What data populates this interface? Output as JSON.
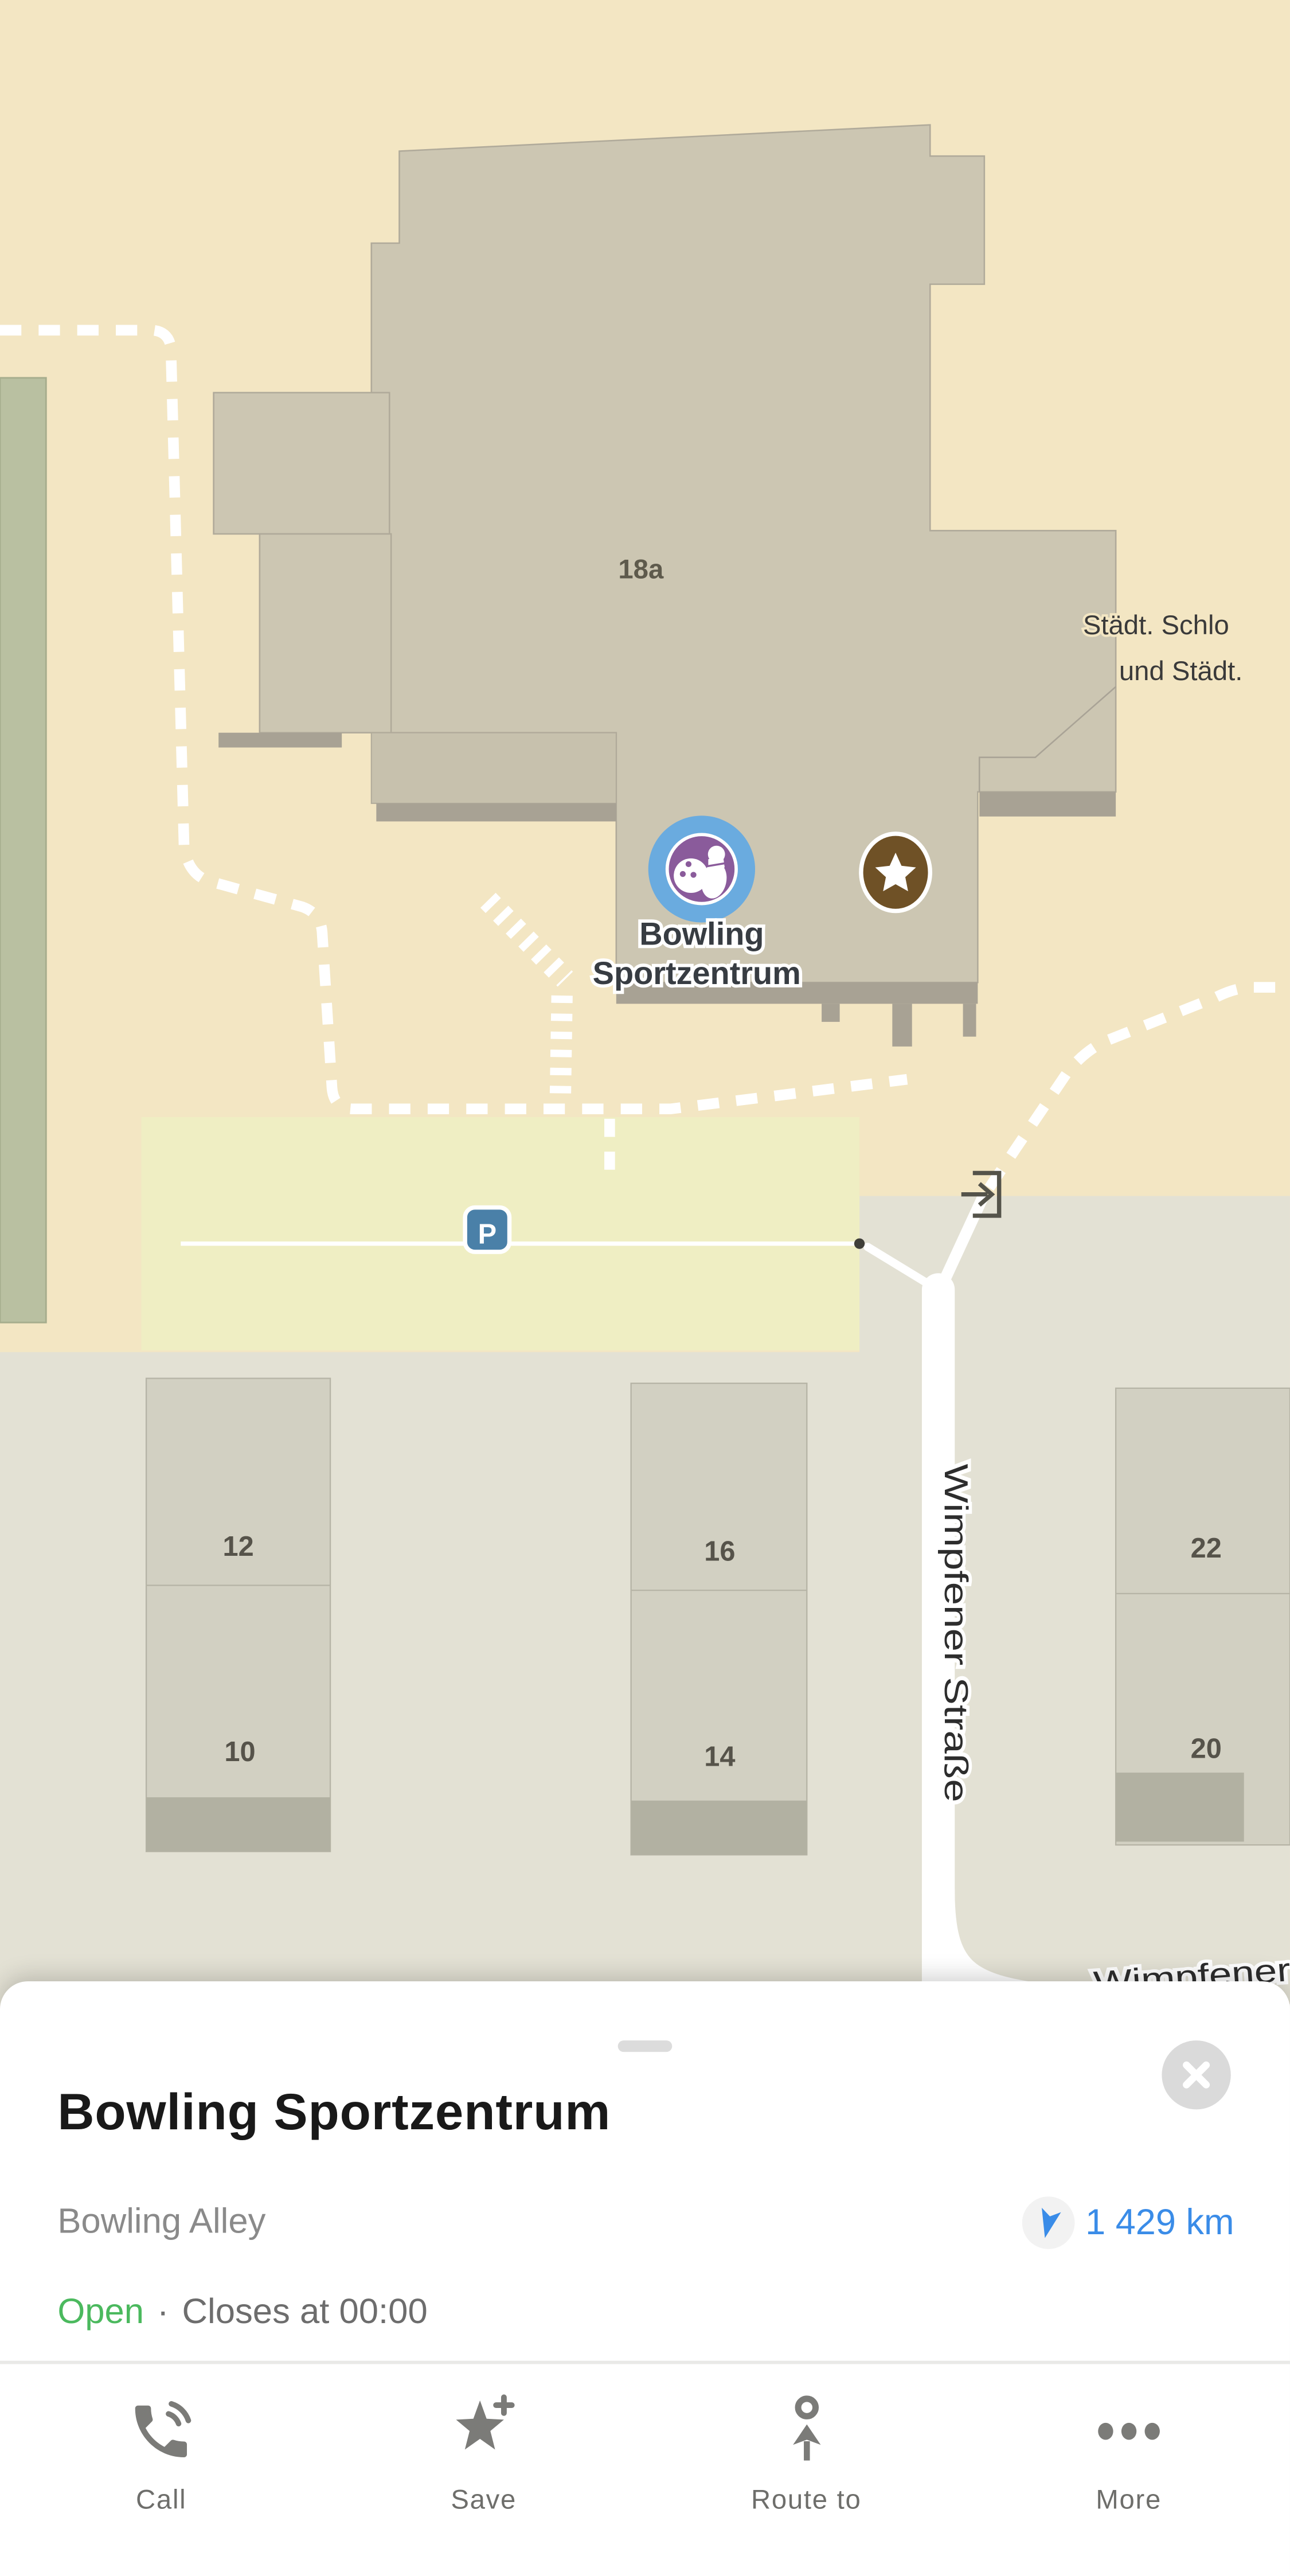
{
  "map": {
    "poi": {
      "name_line1": "Bowling",
      "name_line2": "Sportzentrum"
    },
    "labels": {
      "building_number": "18a",
      "place_right_line1": "Städt. Schlo",
      "place_right_line2": "und Städt.",
      "street_vertical": "Wimpfener Straße",
      "street_bottom": "Wimpfener",
      "parking": "P",
      "house_numbers": [
        "12",
        "10",
        "16",
        "14",
        "22",
        "20"
      ]
    },
    "icons": [
      "bowling-poi-icon",
      "saved-star-icon",
      "parking-icon",
      "entrance-arrow-icon"
    ],
    "colors": {
      "land": "#f3e6c3",
      "land_south": "#e3e1d4",
      "building_upper": "#ccc6b2",
      "building_shadow": "#a8a294",
      "building_lower": "#d2d0c2",
      "building_lower_band": "#b2b1a2",
      "parking_area": "#efeec3",
      "parking_icon_blue": "#4a80a8",
      "greenery": "#b9c0a1",
      "poi_blue": "#6aabdf",
      "poi_purple": "#8a5b9b",
      "saved_brown": "#6f5126",
      "path_white": "#ffffff"
    }
  },
  "sheet": {
    "title": "Bowling Sportzentrum",
    "category": "Bowling Alley",
    "distance": "1 429 km",
    "status": {
      "open": "Open",
      "separator": "·",
      "closes": "Closes at 00:00"
    },
    "accent_blue": "#3a8ce8",
    "open_green": "#4bb95e",
    "actions": [
      {
        "name": "call",
        "label": "Call"
      },
      {
        "name": "save",
        "label": "Save"
      },
      {
        "name": "route",
        "label": "Route to"
      },
      {
        "name": "more",
        "label": "More"
      }
    ]
  }
}
